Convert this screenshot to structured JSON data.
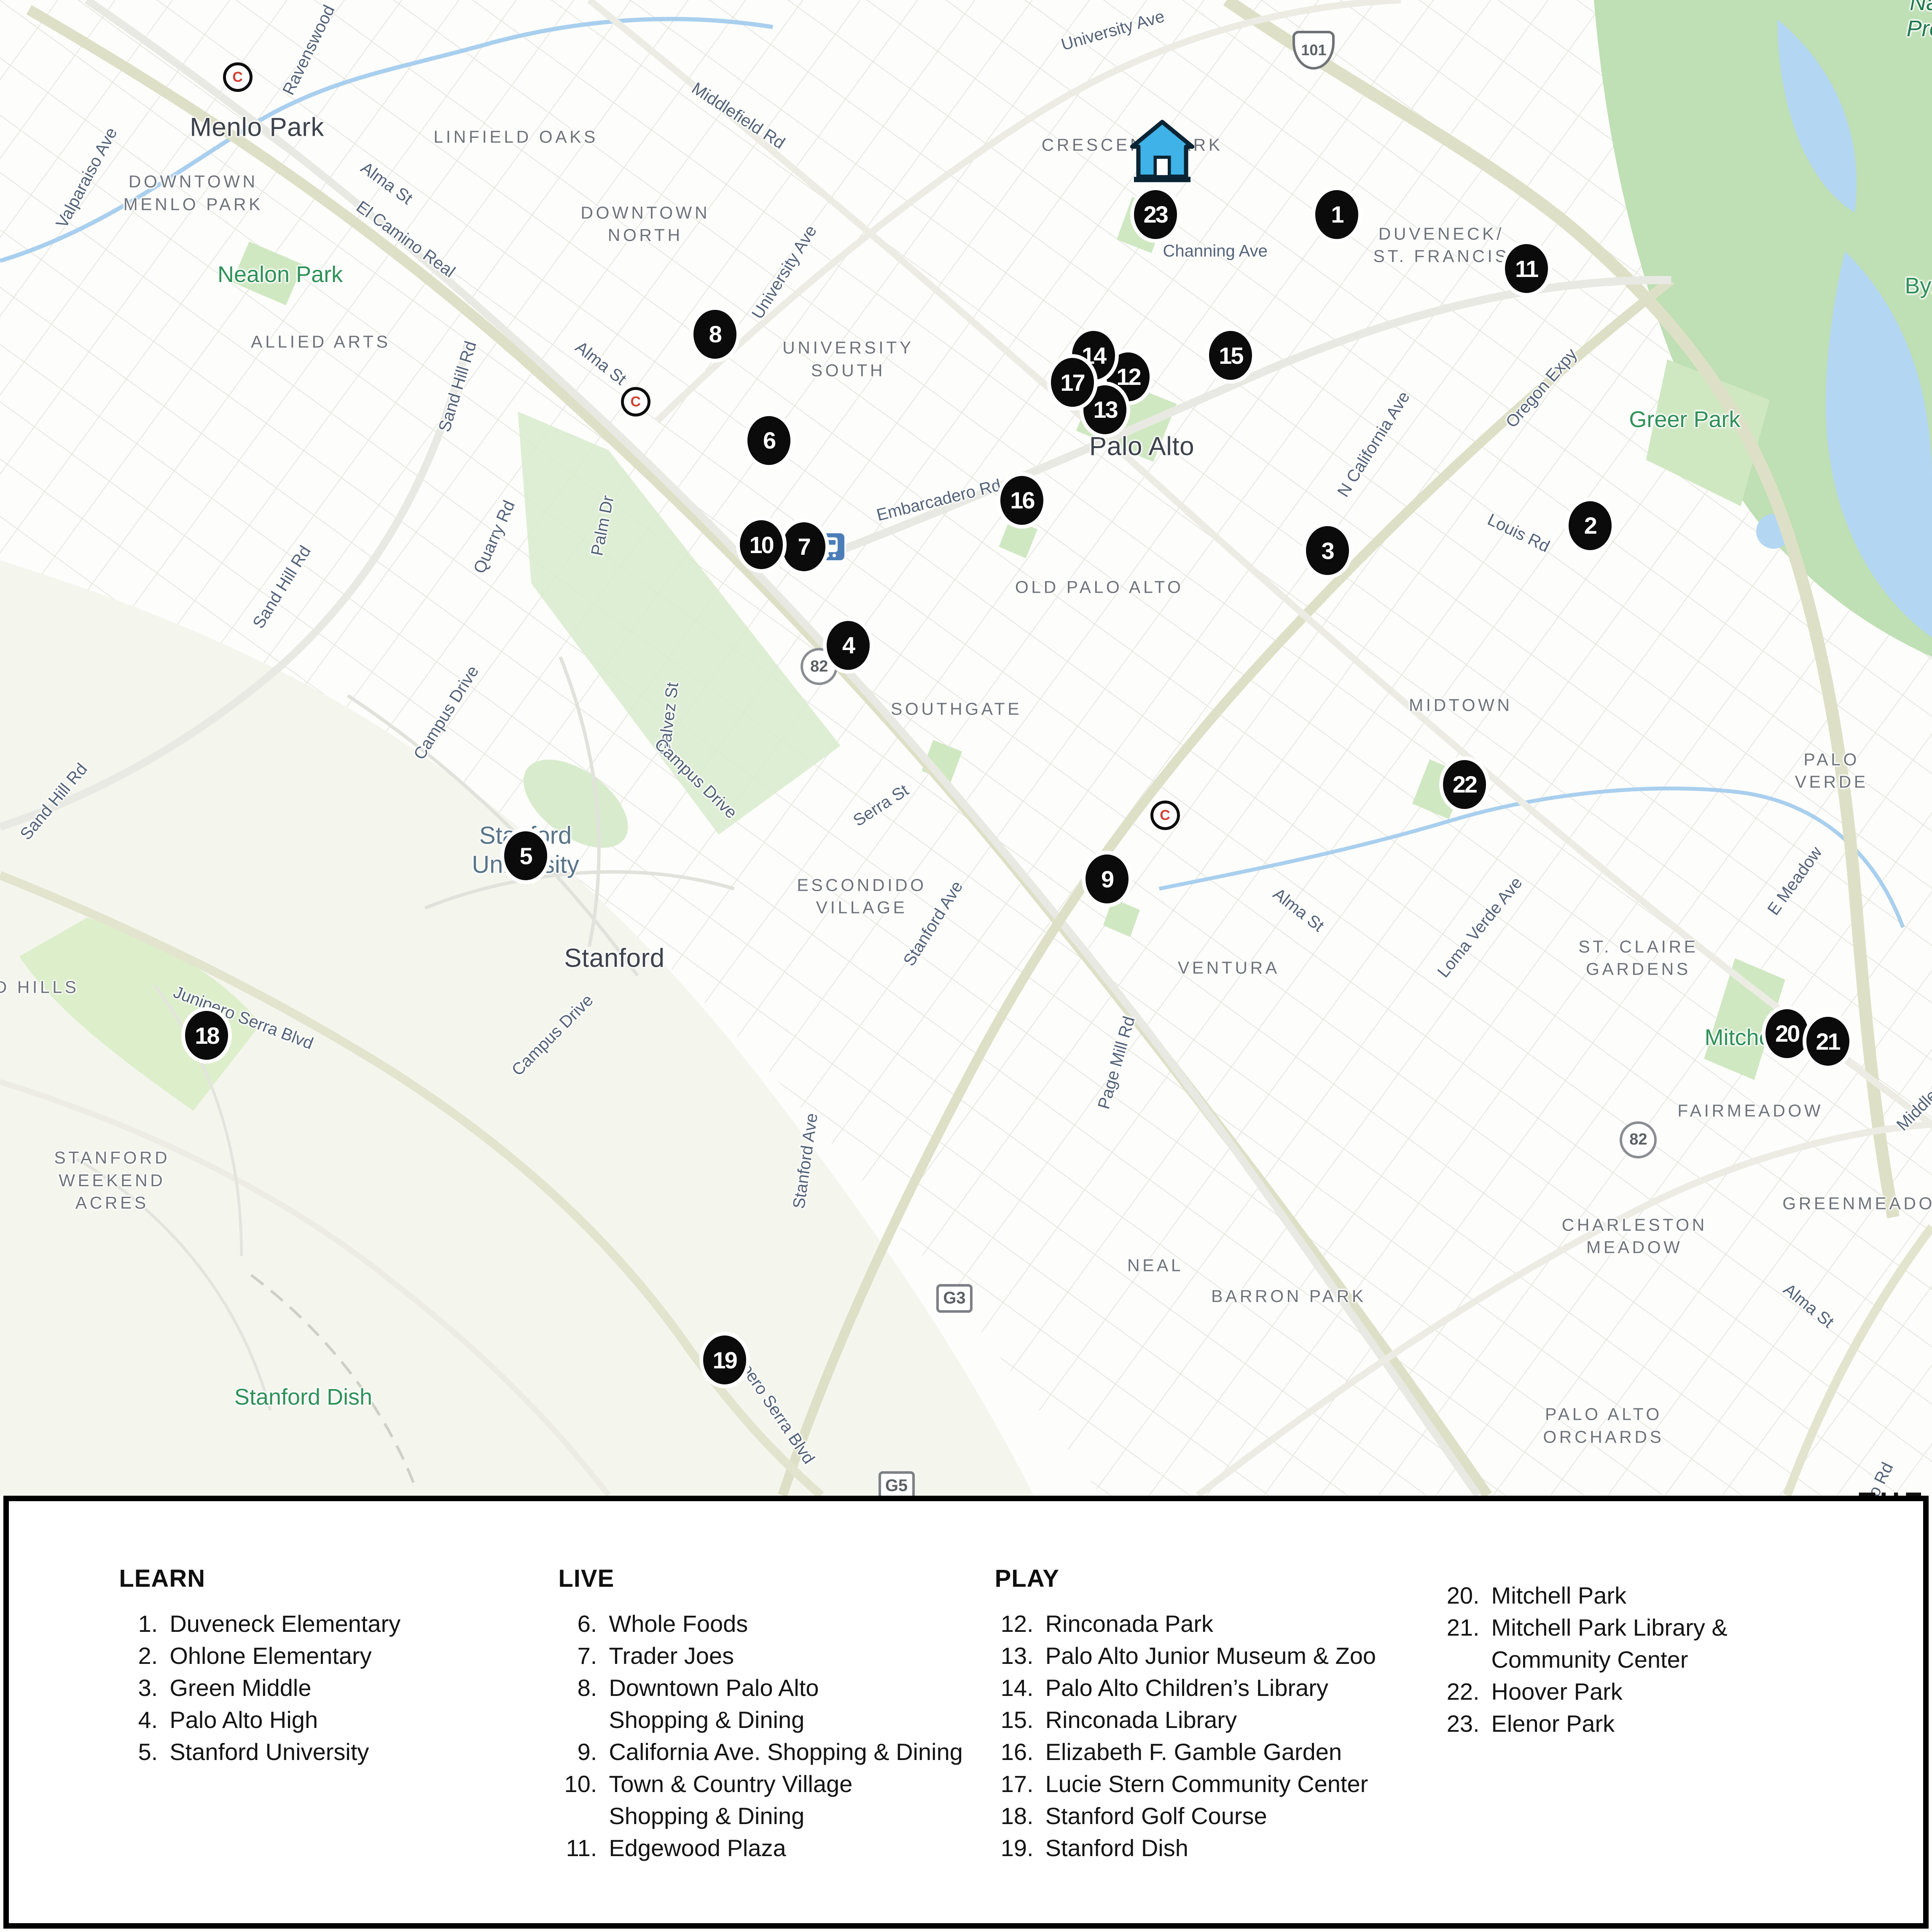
{
  "map": {
    "city_labels": [
      {
        "text": "Menlo Park",
        "x": 13.3,
        "y": 6.6
      },
      {
        "text": "Palo Alto",
        "x": 59.1,
        "y": 23.1
      },
      {
        "text": "Stanford",
        "x": 31.8,
        "y": 49.6
      }
    ],
    "university_label": {
      "text": "Stanford\nUniversity",
      "x": 27.2,
      "y": 44.0
    },
    "neighborhood_labels": [
      {
        "text": "DOWNTOWN\nMENLO PARK",
        "x": 10.0,
        "y": 10.0
      },
      {
        "text": "LINFIELD OAKS",
        "x": 26.7,
        "y": 7.1
      },
      {
        "text": "DOWNTOWN\nNORTH",
        "x": 33.4,
        "y": 11.6
      },
      {
        "text": "CRESCENT PARK",
        "x": 58.6,
        "y": 7.5
      },
      {
        "text": "DUVENECK/\nST. FRANCIS",
        "x": 74.6,
        "y": 12.7
      },
      {
        "text": "ALLIED ARTS",
        "x": 16.6,
        "y": 17.7
      },
      {
        "text": "UNIVERSITY\nSOUTH",
        "x": 43.9,
        "y": 18.6
      },
      {
        "text": "OLD PALO ALTO",
        "x": 56.9,
        "y": 30.4
      },
      {
        "text": "SOUTHGATE",
        "x": 49.5,
        "y": 36.7
      },
      {
        "text": "MIDTOWN",
        "x": 75.6,
        "y": 36.5
      },
      {
        "text": "PALO VERDE",
        "x": 94.8,
        "y": 39.9
      },
      {
        "text": "ESCONDIDO\nVILLAGE",
        "x": 44.6,
        "y": 46.4
      },
      {
        "text": "VENTURA",
        "x": 63.6,
        "y": 50.1
      },
      {
        "text": "ST. CLAIRE\nGARDENS",
        "x": 84.8,
        "y": 49.6
      },
      {
        "text": "FAIRMEADOW",
        "x": 90.6,
        "y": 57.5
      },
      {
        "text": "STANFORD\nWEEKEND\nACRES",
        "x": 5.8,
        "y": 61.1
      },
      {
        "text": "CHARLESTON\nMEADOW",
        "x": 84.6,
        "y": 64.0
      },
      {
        "text": "GREENMEADOW",
        "x": 96.7,
        "y": 62.3
      },
      {
        "text": "NEAL",
        "x": 59.8,
        "y": 65.5
      },
      {
        "text": "BARRON PARK",
        "x": 66.7,
        "y": 67.1
      },
      {
        "text": "PALO ALTO\nORCHARDS",
        "x": 83.0,
        "y": 73.8
      },
      {
        "text": "D HILLS",
        "x": 1.9,
        "y": 51.1
      }
    ],
    "street_labels": [
      {
        "text": "Valparaiso Ave",
        "x": 4.5,
        "y": 9.2,
        "rot": -62
      },
      {
        "text": "Ravenswood",
        "x": 16.0,
        "y": 2.6,
        "rot": -64
      },
      {
        "text": "University Ave",
        "x": 57.6,
        "y": 1.6,
        "rot": -16
      },
      {
        "text": "Middlefield Rd",
        "x": 38.2,
        "y": 6.0,
        "rot": 33
      },
      {
        "text": "Alma St",
        "x": 20.0,
        "y": 9.5,
        "rot": 36
      },
      {
        "text": "El Camino Real",
        "x": 21.0,
        "y": 12.4,
        "rot": 36
      },
      {
        "text": "University Ave",
        "x": 40.6,
        "y": 14.1,
        "rot": -58
      },
      {
        "text": "Alma St",
        "x": 31.1,
        "y": 18.8,
        "rot": 38
      },
      {
        "text": "Sand Hill Rd",
        "x": 23.7,
        "y": 20.0,
        "rot": -73
      },
      {
        "text": "Quarry Rd",
        "x": 25.6,
        "y": 27.8,
        "rot": -66
      },
      {
        "text": "Palm Dr",
        "x": 31.2,
        "y": 27.2,
        "rot": -79
      },
      {
        "text": "Sand Hill Rd",
        "x": 14.6,
        "y": 30.4,
        "rot": -58
      },
      {
        "text": "Sand Hill Rd",
        "x": 2.8,
        "y": 41.5,
        "rot": -50
      },
      {
        "text": "Campus Drive",
        "x": 23.1,
        "y": 36.9,
        "rot": -58
      },
      {
        "text": "Galvez St",
        "x": 34.6,
        "y": 37.2,
        "rot": -83
      },
      {
        "text": "Campus Drive",
        "x": 36.0,
        "y": 40.3,
        "rot": 44
      },
      {
        "text": "Serra St",
        "x": 45.6,
        "y": 41.7,
        "rot": -33
      },
      {
        "text": "Stanford Ave",
        "x": 48.3,
        "y": 47.8,
        "rot": -58
      },
      {
        "text": "Campus Drive",
        "x": 28.6,
        "y": 53.6,
        "rot": -45
      },
      {
        "text": "Stanford Ave",
        "x": 41.7,
        "y": 60.1,
        "rot": -82
      },
      {
        "text": "Junipero Serra Blvd",
        "x": 12.6,
        "y": 52.7,
        "rot": 21
      },
      {
        "text": "Junipero Serra Blvd",
        "x": 39.8,
        "y": 72.5,
        "rot": 56
      },
      {
        "text": "Embarcadero Rd",
        "x": 48.6,
        "y": 25.9,
        "rot": -14
      },
      {
        "text": "Channing Ave",
        "x": 62.9,
        "y": 13.0,
        "rot": 0
      },
      {
        "text": "N California Ave",
        "x": 71.1,
        "y": 23.0,
        "rot": -58
      },
      {
        "text": "Oregon Expy",
        "x": 79.8,
        "y": 20.1,
        "rot": -49
      },
      {
        "text": "Louis Rd",
        "x": 78.6,
        "y": 27.6,
        "rot": 26
      },
      {
        "text": "Alma St",
        "x": 67.2,
        "y": 47.1,
        "rot": 38
      },
      {
        "text": "Loma Verde Ave",
        "x": 76.6,
        "y": 48.0,
        "rot": -51
      },
      {
        "text": "E Meadow",
        "x": 92.9,
        "y": 45.6,
        "rot": -54
      },
      {
        "text": "Page Mill Rd",
        "x": 57.8,
        "y": 55.0,
        "rot": -74
      },
      {
        "text": "Middlefield",
        "x": 99.8,
        "y": 56.9,
        "rot": -45
      },
      {
        "text": "Alma St",
        "x": 93.6,
        "y": 67.6,
        "rot": 39
      },
      {
        "text": "nio Rd",
        "x": 97.2,
        "y": 76.9,
        "rot": -64
      }
    ],
    "park_labels": [
      {
        "text": "Nealon Park",
        "x": 14.5,
        "y": 14.2
      },
      {
        "text": "Greer Park",
        "x": 87.2,
        "y": 21.7
      },
      {
        "text": "Mitchell Park",
        "x": 91.6,
        "y": 53.7
      },
      {
        "text": "Stanford Dish",
        "x": 15.7,
        "y": 72.3
      },
      {
        "text": "Byxb",
        "x": 99.9,
        "y": 14.8
      },
      {
        "text": "Na\nPre",
        "x": 99.6,
        "y": 0.8,
        "italic": true
      }
    ],
    "shields": [
      {
        "text": "101",
        "shape": "us",
        "x": 68.0,
        "y": 2.6
      },
      {
        "text": "82",
        "shape": "circle",
        "x": 42.4,
        "y": 34.5
      },
      {
        "text": "82",
        "shape": "circle",
        "x": 84.8,
        "y": 59.0
      },
      {
        "text": "G3",
        "shape": "square",
        "x": 49.4,
        "y": 67.2
      },
      {
        "text": "G5",
        "shape": "square",
        "x": 46.4,
        "y": 76.9
      }
    ],
    "stations": [
      {
        "type": "caltrain",
        "label": "C",
        "x": 12.3,
        "y": 4.0
      },
      {
        "type": "caltrain",
        "label": "C",
        "x": 32.9,
        "y": 20.8
      },
      {
        "type": "transit",
        "label": "",
        "x": 43.0,
        "y": 28.3
      },
      {
        "type": "caltrain",
        "label": "C",
        "x": 60.3,
        "y": 42.2
      }
    ],
    "home": {
      "x": 60.15,
      "y": 8.1,
      "color": "#3fb2e8"
    },
    "markers": [
      {
        "n": "1",
        "x": 69.2,
        "y": 11.1
      },
      {
        "n": "2",
        "x": 82.3,
        "y": 27.2
      },
      {
        "n": "3",
        "x": 68.7,
        "y": 28.5
      },
      {
        "n": "4",
        "x": 43.9,
        "y": 33.4
      },
      {
        "n": "5",
        "x": 27.2,
        "y": 44.3
      },
      {
        "n": "6",
        "x": 39.8,
        "y": 22.8
      },
      {
        "n": "7",
        "x": 41.6,
        "y": 28.3
      },
      {
        "n": "8",
        "x": 37.0,
        "y": 17.3
      },
      {
        "n": "9",
        "x": 57.3,
        "y": 45.5
      },
      {
        "n": "10",
        "x": 39.4,
        "y": 28.2
      },
      {
        "n": "11",
        "x": 79.0,
        "y": 13.9
      },
      {
        "n": "12",
        "x": 58.4,
        "y": 19.5
      },
      {
        "n": "13",
        "x": 57.2,
        "y": 21.2
      },
      {
        "n": "14",
        "x": 56.6,
        "y": 18.4
      },
      {
        "n": "15",
        "x": 63.7,
        "y": 18.4
      },
      {
        "n": "16",
        "x": 52.9,
        "y": 25.9
      },
      {
        "n": "17",
        "x": 55.5,
        "y": 19.8
      },
      {
        "n": "18",
        "x": 10.7,
        "y": 53.6
      },
      {
        "n": "19",
        "x": 37.5,
        "y": 70.4
      },
      {
        "n": "20",
        "x": 92.5,
        "y": 53.5
      },
      {
        "n": "21",
        "x": 94.6,
        "y": 53.9
      },
      {
        "n": "22",
        "x": 75.8,
        "y": 40.6
      },
      {
        "n": "23",
        "x": 59.8,
        "y": 11.1
      }
    ],
    "marker_color": "#0b0b0b"
  },
  "legend": {
    "partial_text": "THE",
    "columns": [
      {
        "header": "LEARN",
        "x": 5.75,
        "items": [
          {
            "num": "1.",
            "lines": [
              "Duveneck Elementary"
            ]
          },
          {
            "num": "2.",
            "lines": [
              "Ohlone Elementary"
            ]
          },
          {
            "num": "3.",
            "lines": [
              "Green Middle"
            ]
          },
          {
            "num": "4.",
            "lines": [
              "Palo Alto High"
            ]
          },
          {
            "num": "5.",
            "lines": [
              "Stanford University"
            ]
          }
        ]
      },
      {
        "header": "LIVE",
        "x": 28.7,
        "items": [
          {
            "num": "6.",
            "lines": [
              "Whole Foods"
            ]
          },
          {
            "num": "7.",
            "lines": [
              "Trader Joes"
            ]
          },
          {
            "num": "8.",
            "lines": [
              "Downtown Palo Alto",
              "Shopping & Dining"
            ]
          },
          {
            "num": "9.",
            "lines": [
              "California Ave. Shopping & Dining"
            ]
          },
          {
            "num": "10.",
            "lines": [
              "Town & Country Village",
              "Shopping & Dining"
            ]
          },
          {
            "num": "11.",
            "lines": [
              "Edgewood Plaza"
            ]
          }
        ]
      },
      {
        "header": "PLAY",
        "x": 51.5,
        "items": [
          {
            "num": "12.",
            "lines": [
              "Rinconada Park"
            ]
          },
          {
            "num": "13.",
            "lines": [
              "Palo Alto Junior Museum & Zoo"
            ]
          },
          {
            "num": "14.",
            "lines": [
              "Palo Alto Children’s Library"
            ]
          },
          {
            "num": "15.",
            "lines": [
              "Rinconada Library"
            ]
          },
          {
            "num": "16.",
            "lines": [
              "Elizabeth F. Gamble Garden"
            ]
          },
          {
            "num": "17.",
            "lines": [
              "Lucie Stern Community Center"
            ]
          },
          {
            "num": "18.",
            "lines": [
              "Stanford Golf Course"
            ]
          },
          {
            "num": "19.",
            "lines": [
              "Stanford Dish"
            ]
          }
        ]
      },
      {
        "header": "",
        "x": 74.8,
        "items": [
          {
            "num": "20.",
            "lines": [
              "Mitchell Park"
            ]
          },
          {
            "num": "21.",
            "lines": [
              "Mitchell Park Library &",
              "Community Center"
            ]
          },
          {
            "num": "22.",
            "lines": [
              "Hoover Park"
            ]
          },
          {
            "num": "23.",
            "lines": [
              "Elenor Park"
            ]
          }
        ]
      }
    ]
  },
  "colors": {
    "marker": "#0b0b0b",
    "home_blue": "#3fb2e8",
    "park_green": "#cfe8c2",
    "preserve_green": "#bfdfb4",
    "water_blue": "#b3d6f2",
    "road_olive": "#dde0c6",
    "street_label": "#4b5b72",
    "neighborhood_label": "#6e737a",
    "park_label": "#2f9158",
    "legend_border": "#000000"
  }
}
